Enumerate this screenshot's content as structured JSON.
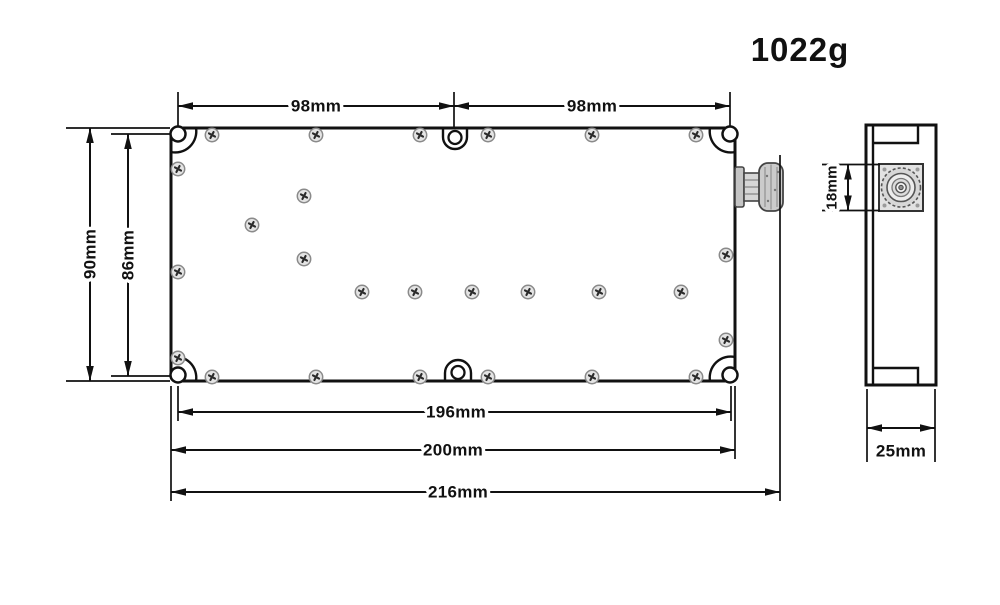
{
  "weight_label": "1022g",
  "front_view": {
    "dim_top_left": "98mm",
    "dim_top_right": "98mm",
    "dim_height_overall": "90mm",
    "dim_height_holes": "86mm",
    "dim_width_holes": "196mm",
    "dim_width_body": "200mm",
    "dim_width_overall": "216mm"
  },
  "side_view": {
    "dim_connector_height": "18mm",
    "dim_depth": "25mm"
  }
}
